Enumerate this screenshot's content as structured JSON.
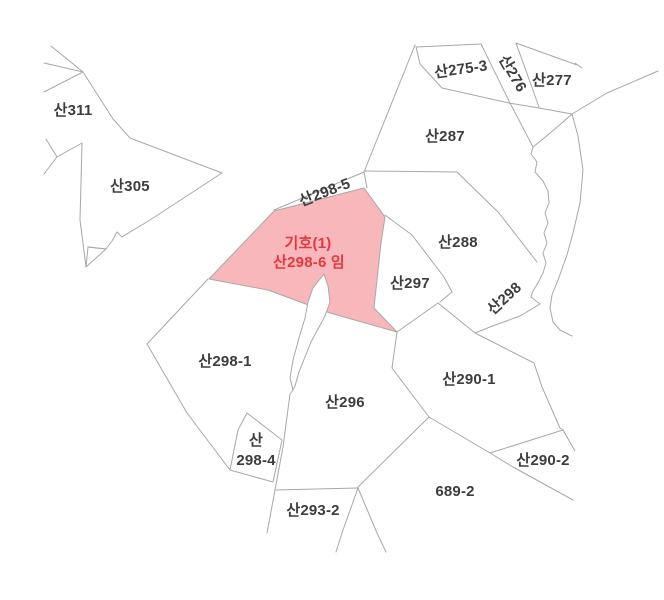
{
  "map": {
    "type": "cadastral-parcel-map",
    "background": "#ffffff",
    "line_color": "#a8a8a8",
    "label_color": "#3d3d3d",
    "highlight": {
      "fill": "#f8b7ba",
      "label_color": "#e2393d",
      "designation": "기호(1)",
      "parcel": "산298-6 임"
    },
    "parcels": [
      {
        "label": "산311",
        "x": 73,
        "y": 111
      },
      {
        "label": "산305",
        "x": 130,
        "y": 187
      },
      {
        "label": "산275-3",
        "x": 461,
        "y": 70,
        "rot": -8
      },
      {
        "label": "산276",
        "x": 512,
        "y": 74,
        "rot": 60
      },
      {
        "label": "산277",
        "x": 552,
        "y": 81
      },
      {
        "label": "산287",
        "x": 445,
        "y": 137
      },
      {
        "label": "산298-5",
        "x": 325,
        "y": 193,
        "rot": -21
      },
      {
        "label": "기호(1)",
        "x": 308,
        "y": 244,
        "highlight": true
      },
      {
        "label": "산298-6 임",
        "x": 309,
        "y": 263,
        "highlight": true
      },
      {
        "label": "산288",
        "x": 458,
        "y": 243
      },
      {
        "label": "산297",
        "x": 410,
        "y": 284
      },
      {
        "label": "산298",
        "x": 505,
        "y": 299,
        "rot": -42
      },
      {
        "label": "산298-1",
        "x": 225,
        "y": 362
      },
      {
        "label": "산290-1",
        "x": 469,
        "y": 380
      },
      {
        "label": "산296",
        "x": 345,
        "y": 403
      },
      {
        "label": "산",
        "x": 256,
        "y": 441
      },
      {
        "label": "298-4",
        "x": 256,
        "y": 461
      },
      {
        "label": "산290-2",
        "x": 543,
        "y": 461
      },
      {
        "label": "689-2",
        "x": 455,
        "y": 492
      },
      {
        "label": "산293-2",
        "x": 313,
        "y": 511
      }
    ]
  }
}
